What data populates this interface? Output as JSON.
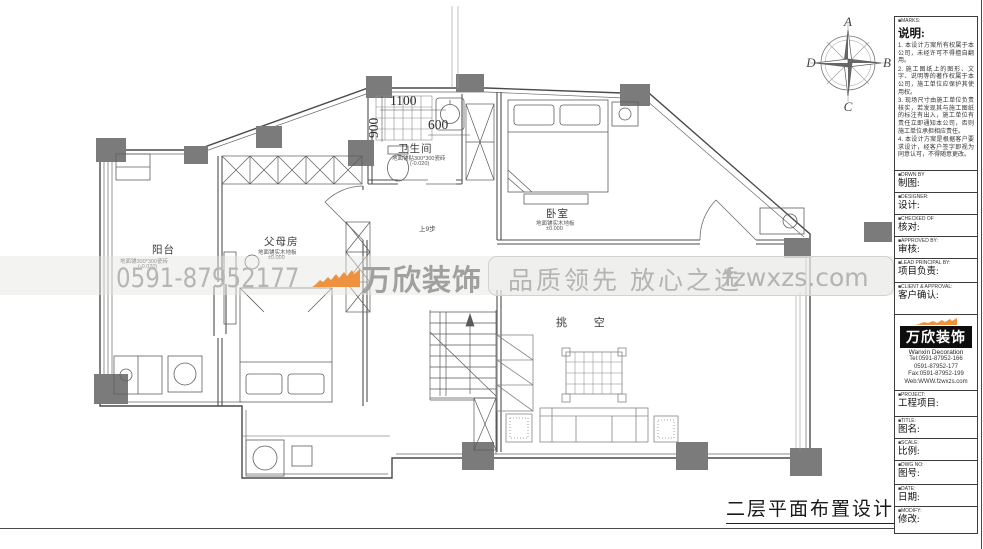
{
  "sheet": {
    "title": "二层平面布置设计图"
  },
  "watermark": {
    "phone": "0591-87952177",
    "brand": "万欣装饰",
    "slogan": "品质领先 放心之选",
    "website": "fzwxzs.com",
    "accent_color": "#ef9240"
  },
  "compass": {
    "n": "A",
    "e": "B",
    "s": "C",
    "w": "D"
  },
  "rooms": {
    "balcony": {
      "name": "阳台",
      "finish": "地面铺300*300瓷砖",
      "level": "(-0.020)"
    },
    "parents": {
      "name": "父母房",
      "finish": "地面铺实木地板",
      "level": "±0.000"
    },
    "bath": {
      "name": "卫生间",
      "finish": "地面铺贴300*300瓷砖",
      "level": "(-0.020)"
    },
    "bedroom": {
      "name": "卧室",
      "finish": "地面铺实木地板",
      "level": "±0.000"
    },
    "void": {
      "name": "挑 空"
    }
  },
  "dims": {
    "d1100": "1100",
    "d900": "900",
    "d600": "600",
    "stair_note": "上9步"
  },
  "title_block": {
    "notes": {
      "tag": "■MARKS:",
      "title": "说明:",
      "items": [
        "1. 本设计方案所有权属于本公司，未经许可不得擅自翻用。",
        "2. 施工图纸上的图形、文字、说明等的著作权属于本公司，施工单位应保护其使用权。",
        "3. 现场尺寸由施工单位负责核实，若发现其与施工图纸的标注有出入，施工单位有责任立即通知本公司，否则施工单位承担相应责任。",
        "4. 本设计方案是根据客户要求设计，经客户签字即视为同意认可，不得随意更改。"
      ]
    },
    "fields": [
      {
        "tag": "■DRWN BY",
        "label": "制图:"
      },
      {
        "tag": "■DESIGNER:",
        "label": "设计:"
      },
      {
        "tag": "■CHECKED OF",
        "label": "核对:"
      },
      {
        "tag": "■APPROVED BY:",
        "label": "审核:"
      },
      {
        "tag": "■LEAD PRINCIPAL BY:",
        "label": "项目负责:"
      },
      {
        "tag": "■CLIENT & APPROVAL:",
        "label": "客户确认:"
      }
    ],
    "logo": {
      "brand": "万欣装饰",
      "company": "Wanxin Decoration",
      "tel1": "Tel:0591-87952-166",
      "tel2": "0591-87952-177",
      "fax": "Fax:0591-87952-199",
      "web": "Web:WWW.fzwxzs.com"
    },
    "fields2": [
      {
        "tag": "■PROJECT:",
        "label": "工程项目:"
      },
      {
        "tag": "■TITLE:",
        "label": "图名:"
      },
      {
        "tag": "■SCALE:",
        "label": "比例:"
      },
      {
        "tag": "■DWG NO:",
        "label": "图号:"
      },
      {
        "tag": "■DATE:",
        "label": "日期:"
      },
      {
        "tag": "■MODIFY:",
        "label": "修改:"
      }
    ]
  }
}
